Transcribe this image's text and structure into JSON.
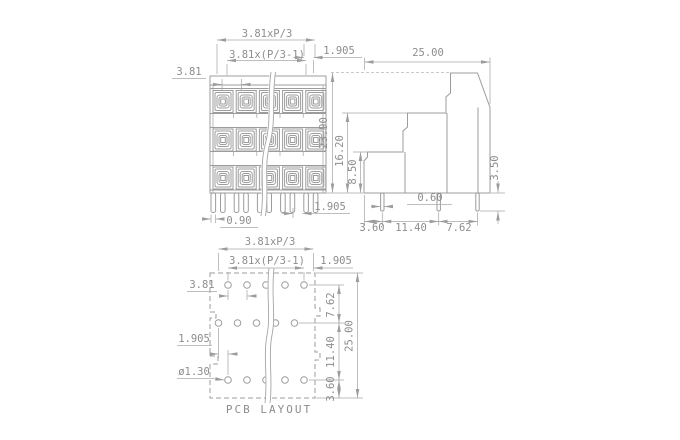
{
  "front_view": {
    "dim_pitch_total": "3.81xP/3",
    "dim_pitch_inner": "3.81x(P/3-1)",
    "dim_pitch": "3.81",
    "dim_pin_row_offset_top": "1.905",
    "dim_pin_width": "0.90",
    "dim_pin_pair_offset": "1.905"
  },
  "side_view": {
    "dim_depth": "25.00",
    "dim_height_total": "23.90",
    "dim_height_middle": "16.20",
    "dim_height_lower": "8.50",
    "dim_pin_length": "3.50",
    "dim_pin_width": "0.60",
    "dim_pin_to_edge": "3.60",
    "dim_pin_spacing_a": "11.40",
    "dim_pin_spacing_b": "7.62"
  },
  "pcb_layout": {
    "title": "PCB LAYOUT",
    "dim_pitch_total": "3.81xP/3",
    "dim_pitch_inner": "3.81x(P/3-1)",
    "dim_edge_offset": "1.905",
    "dim_pitch": "3.81",
    "dim_row_offset": "1.905",
    "dim_hole_diameter": "ø1.30",
    "dim_row_gap_a": "7.62",
    "dim_row_gap_b": "11.40",
    "dim_bottom_margin": "3.60",
    "dim_depth_total": "25.00"
  }
}
